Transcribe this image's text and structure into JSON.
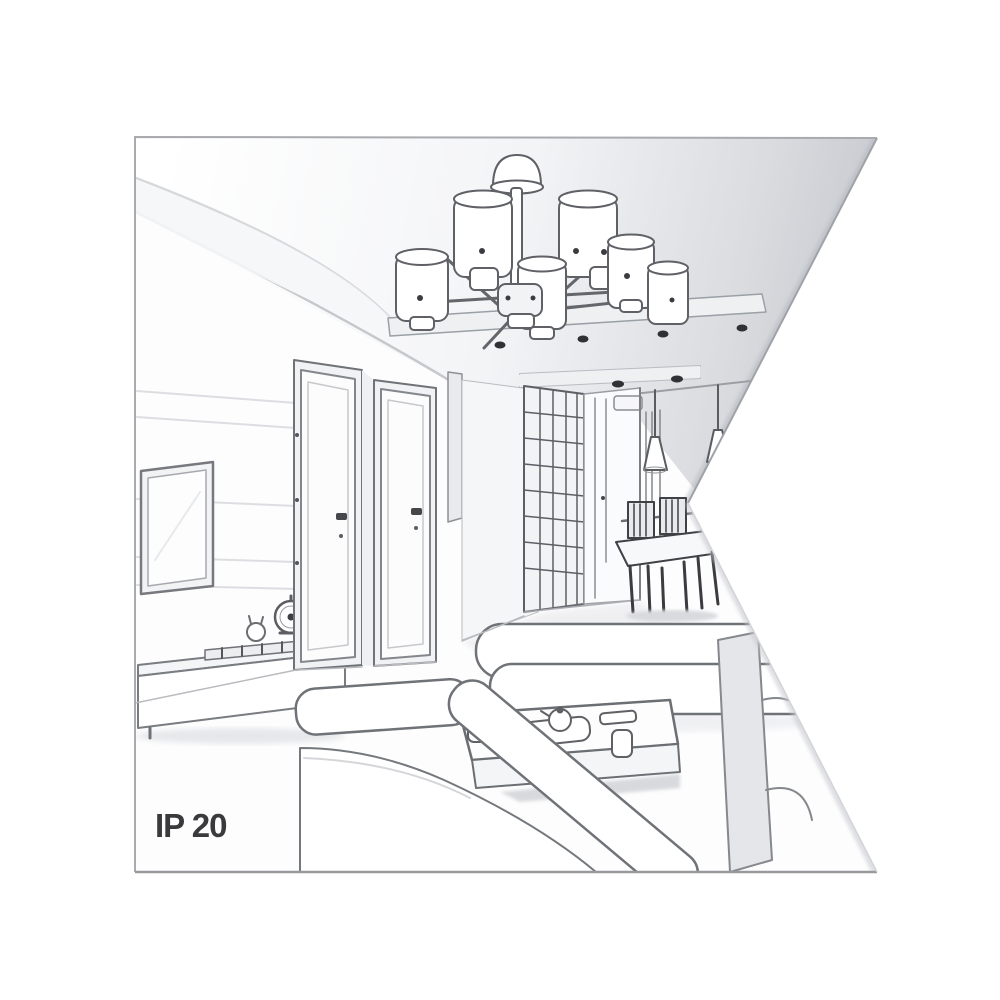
{
  "page": {
    "background_color": "#ffffff",
    "kind": "product illustration – grayscale interior sketch with angled cut-out on right side"
  },
  "artwork": {
    "ip_rating_label": "IP 20",
    "style": "grayscale pencil/vector line drawing of a living room in perspective",
    "colors": {
      "paper": "#fdfdfe",
      "line": "#6f7277",
      "line_dark": "#3a3c40",
      "ceiling_shade": "#c6c9ce",
      "soft_shadow": "#e7e8eb",
      "panel_line": "#dcdee1",
      "frame_border": "#a5a7ab",
      "text": "#3a3a3c"
    },
    "elements": [
      "six-shade ceiling chandelier on dropped ceiling panel",
      "recessed ceiling spotlights",
      "wall-mounted tv on paneled wall",
      "media console with soundbar, alarm clock and figurine",
      "two interior doors with handles",
      "chest of drawers",
      "hallway with grid-front wardrobe and ceiling light",
      "dining table with chairs and two cone pendant lights",
      "sectional sofa and chaise lounge",
      "coffee table with tray, teapot, cups and remote",
      "ip rating text bottom left"
    ]
  }
}
